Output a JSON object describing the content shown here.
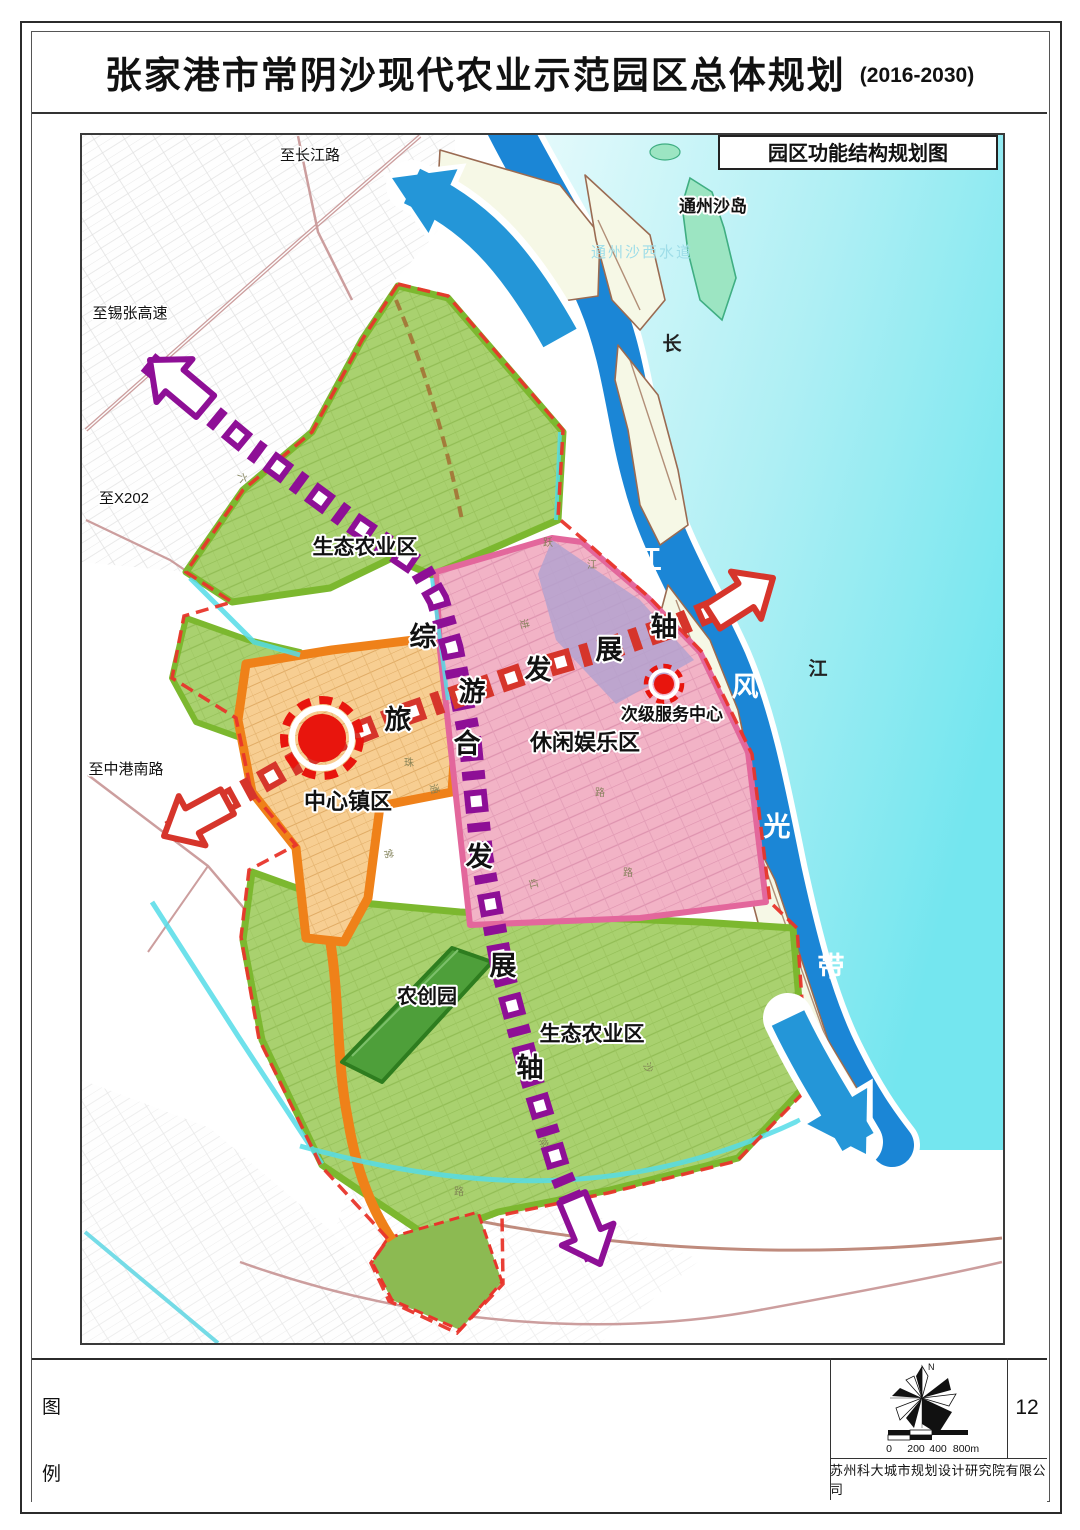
{
  "page": {
    "title": "张家港市常阴沙现代农业示范园区总体规划",
    "title_suffix": "(2016-2030)",
    "page_number": "12",
    "company": "苏州科大城市规划设计研究院有限公司"
  },
  "map": {
    "inset_title": "园区功能结构规划图",
    "zones": {
      "eco_north": "生态农业区",
      "eco_south": "生态农业区",
      "leisure": "休闲娱乐区",
      "agri_innovation": "农创园",
      "central_town": "中心镇区",
      "secondary_center": "次级服务中心"
    },
    "axes": {
      "comprehensive": {
        "name": "综合发展轴",
        "chars": [
          "综",
          "合",
          "发",
          "展",
          "轴"
        ]
      },
      "tourism": {
        "name": "旅游发展轴",
        "chars": [
          "旅",
          "游",
          "发",
          "展",
          "轴"
        ]
      }
    },
    "river": {
      "name_chars": [
        "长",
        "江"
      ],
      "scenic_belt_chars": [
        "沿",
        "江",
        "风",
        "光",
        "带"
      ],
      "island": "通州沙岛",
      "waterway": "通州沙西水道"
    },
    "directions": {
      "changjiang_road": "至长江路",
      "xizhang_expressway": "至锡张高速",
      "x202": "至X202",
      "zhonggang_south_road": "至中港南路"
    },
    "road_labels": [
      "六",
      "跃",
      "江",
      "进",
      "珠",
      "通",
      "常",
      "路",
      "红",
      "路",
      "沙",
      "常",
      "路"
    ]
  },
  "legend": {
    "chars": [
      "图",
      "例"
    ]
  },
  "compass": {
    "north": "N"
  },
  "scalebar": {
    "labels": [
      "0",
      "200",
      "400",
      "800m"
    ]
  },
  "colors": {
    "water": "#BEEFF4",
    "channel": "#1B86D6",
    "eco_green": "#A9D16F",
    "eco_border": "#7CB82F",
    "leisure_pink": "#F2B3C6",
    "pink_border": "#E3679C",
    "town_orange": "#F7CE92",
    "orange_border": "#EF8119",
    "axis_purple": "#8E0F96",
    "axis_red": "#D6352B",
    "marker_red": "#E8150D",
    "flow_arrow_blue": "#2496D8",
    "boundary_red": "#E8352B"
  }
}
